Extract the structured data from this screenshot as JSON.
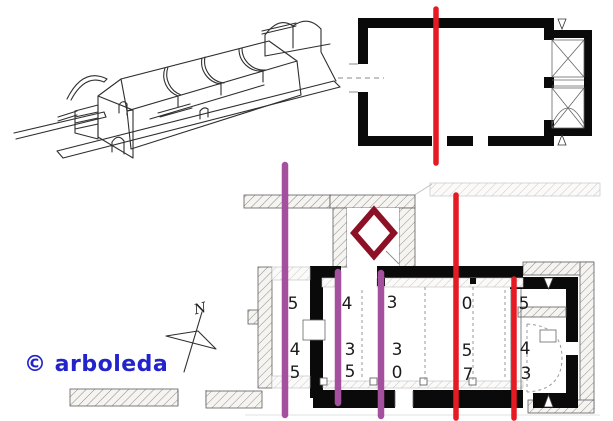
{
  "watermark": {
    "text": "© arboleda"
  },
  "compass": {
    "label": "N"
  },
  "plan_numbers": {
    "rows": [
      [
        "5",
        "4",
        "3",
        "0",
        "5"
      ],
      [
        "4",
        "3",
        "3",
        "5",
        "4"
      ],
      [
        "5",
        "5",
        "0",
        "7",
        "3"
      ]
    ]
  },
  "colors": {
    "overlay_red": "#e51a23",
    "overlay_purple": "#a5509f",
    "marker_maroon": "#8c1127",
    "watermark_blue": "#2323cb",
    "wall_black": "#0a0a0a",
    "sketch_ink": "#2f2f2f"
  }
}
